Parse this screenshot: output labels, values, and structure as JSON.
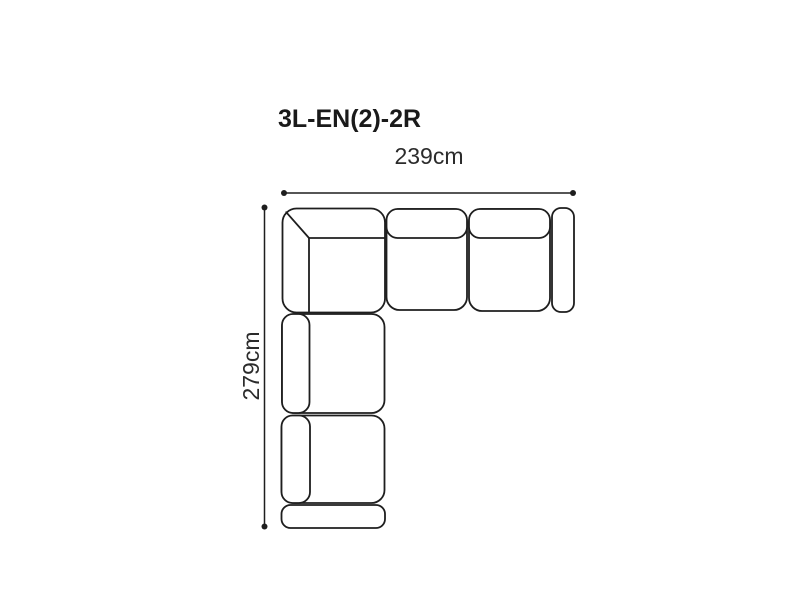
{
  "title": "3L-EN(2)-2R",
  "dimension_labels": {
    "width": "239cm",
    "depth": "279cm"
  },
  "diagram": {
    "type": "sofa-sectional-top-view",
    "units": "cm",
    "width_cm": 239,
    "depth_cm": 279
  },
  "colors": {
    "outline": "#1e1e1e",
    "title_text": "#1a1a1a",
    "label_text": "#2b2b2b",
    "background": "#ffffff"
  }
}
